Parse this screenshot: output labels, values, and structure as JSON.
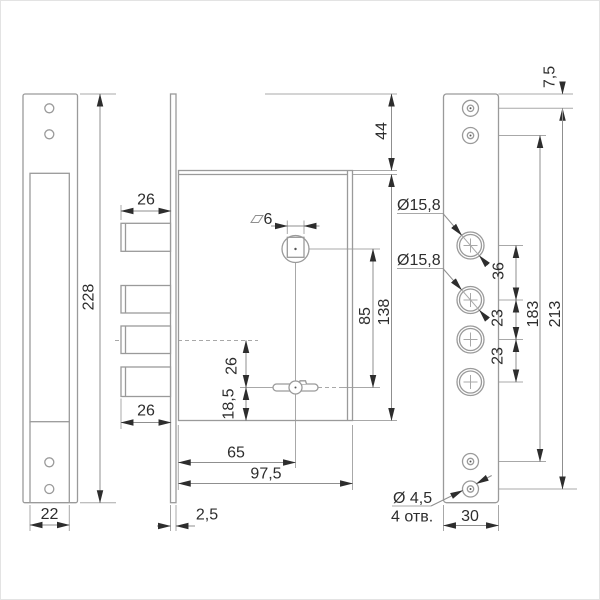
{
  "colors": {
    "line": "#9a9a9a",
    "arrow_text": "#2d2d2d",
    "background": "#ffffff",
    "border": "#e3e3e3"
  },
  "views": {
    "strike_plate": {
      "height": "228",
      "width": "22"
    },
    "lock_body": {
      "offset_top": "44",
      "bolt_width_top": "26",
      "bolt_width_bottom": "26",
      "bolt_axis_to_key_axis": "26",
      "key_axis_to_bottom": "18,5",
      "square_spindle": "6",
      "spindle_to_key_axis": "85",
      "height": "138",
      "edge_to_key_axis": "65",
      "width": "97,5",
      "faceplate_thickness": "2,5"
    },
    "outer_plate": {
      "top_to_screw_axis": "7,5",
      "cylinder_hole_upper": "Ø15,8",
      "cylinder_hole_lower": "Ø15,8",
      "hole_pitch_1": "36",
      "hole_pitch_2": "23",
      "hole_pitch_3": "23",
      "screw_pitch_inner": "183",
      "screw_pitch_outer": "213",
      "width": "30",
      "screw_hole_dia": "Ø 4,5",
      "screw_hole_count": "4 отв."
    }
  }
}
